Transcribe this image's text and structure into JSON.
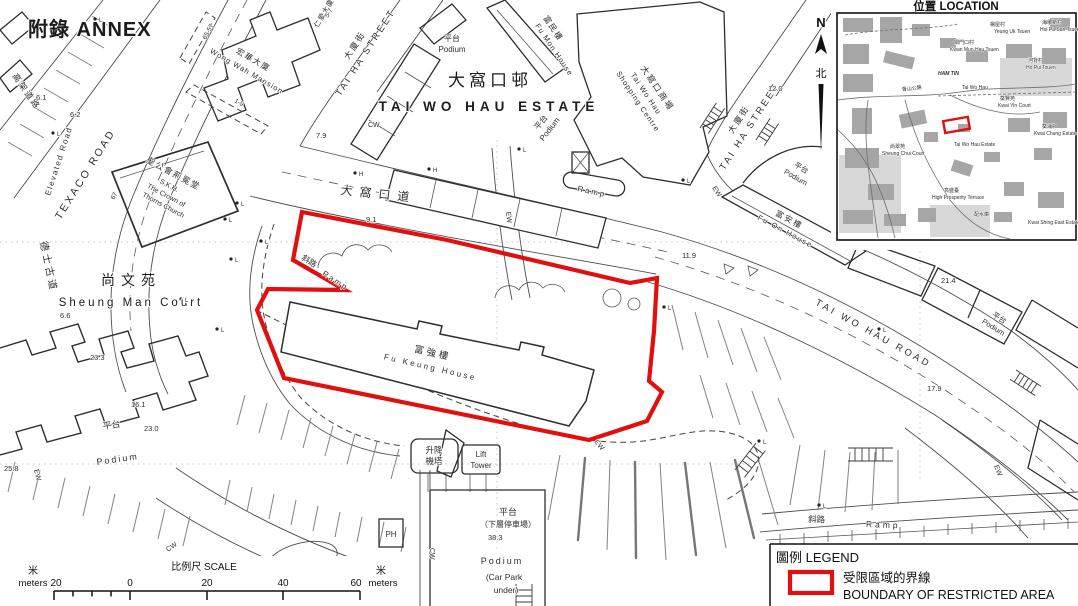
{
  "page": {
    "annex": "附錄  ANNEX"
  },
  "north": {
    "letter": "N",
    "zh": "北"
  },
  "labels": {
    "estate_zh": "大窩口邨",
    "estate_en": "TAI WO HAU ESTATE",
    "fu_keung_zh": "富強樓",
    "fu_keung_en": "Fu Keung House",
    "fu_mon_zh": "富民樓",
    "fu_mon_en": "Fu Mon House",
    "fu_on_zh": "富安樓",
    "fu_on_en": "Fu On House",
    "shopping_zh": "大窩口商場",
    "shopping_en1": "Tai Wo Hau",
    "shopping_en2": "Shopping Centre",
    "sheung_man_zh": "尚文苑",
    "sheung_man_en": "Sheung Man Court",
    "wong_wah_zh": "宏華大廈",
    "wong_wah_en": "Wong Wah Mansion",
    "yan_oi_zh": "仁愛大廈",
    "church_zh": "聖公會荊冕堂",
    "church_en1": "S.K.H.",
    "church_en2": "The Crown of",
    "church_en3": "Thorns Church",
    "texaco_en": "TEXACO ROAD",
    "texaco_zh": "德士古道",
    "elevated_zh": "高架道路",
    "elevated_en": "Elevated Road",
    "tai_ha_zh": "大廈街",
    "tai_ha_en": "TAI HA STREET",
    "twh_dao_zh": "大窩口道",
    "twh_road_en": "TAI WO HAU ROAD",
    "podium_zh": "平台",
    "podium_en": "Podium",
    "carpark_zh": "（下層停車場）",
    "carpark_en1": "(Car Park",
    "carpark_en2": "under)",
    "lift_zh1": "升降",
    "lift_zh2": "機塔",
    "lift_en1": "Lift",
    "lift_en2": "Tower",
    "ramp_zh": "斜路",
    "ramp_en": "Ramp",
    "ph": "PH",
    "cw": "CW",
    "ew": "EW",
    "l": "L",
    "h": "H",
    "num_65_57": "65-57",
    "num_1_9": "1-9",
    "num_67": "67",
    "num_5_7": "5-7"
  },
  "spot_heights": {
    "a": "6.1",
    "b": "6.2",
    "c": "7.9",
    "d": "9.1",
    "e": "12.0",
    "f": "11.9",
    "g": "21.4",
    "h": "17.9",
    "i": "6.6",
    "j": "23.3",
    "k": "16.1",
    "m": "23.0",
    "n": "25.8",
    "o": "38.3"
  },
  "inset": {
    "title": "位置  LOCATION",
    "marker_color": "#e10f0f",
    "labels": [
      "楊屋村",
      "Yeung Uk Tsuen",
      "海壩新村",
      "Hoi Pa San Tsuen",
      "關門口村",
      "Kwan Mun Hau Tsuen",
      "河背村",
      "Ho Pui Tsuen",
      "HAM TIN",
      "青山公路",
      "Tai Wo Hau",
      "葵賢苑",
      "Kwai Yin Court",
      "尚翠苑",
      "Sheung Chui Court",
      "Tai Wo Hau Estate",
      "葵涌邨",
      "Kwai Chung Estate",
      "高盛臺",
      "High Prosperity Terrace",
      "配水庫",
      "Kwai Shing East Estate"
    ]
  },
  "legend": {
    "title": "圖例 LEGEND",
    "item_zh": "受限區域的界線",
    "item_en": "BOUNDARY OF RESTRICTED AREA",
    "color": "#e10f0f"
  },
  "scale": {
    "title": "比例尺  SCALE",
    "unit_zh": "米",
    "unit_en": "meters",
    "t0": "20",
    "t1": "0",
    "t2": "20",
    "t3": "40",
    "t4": "60"
  }
}
